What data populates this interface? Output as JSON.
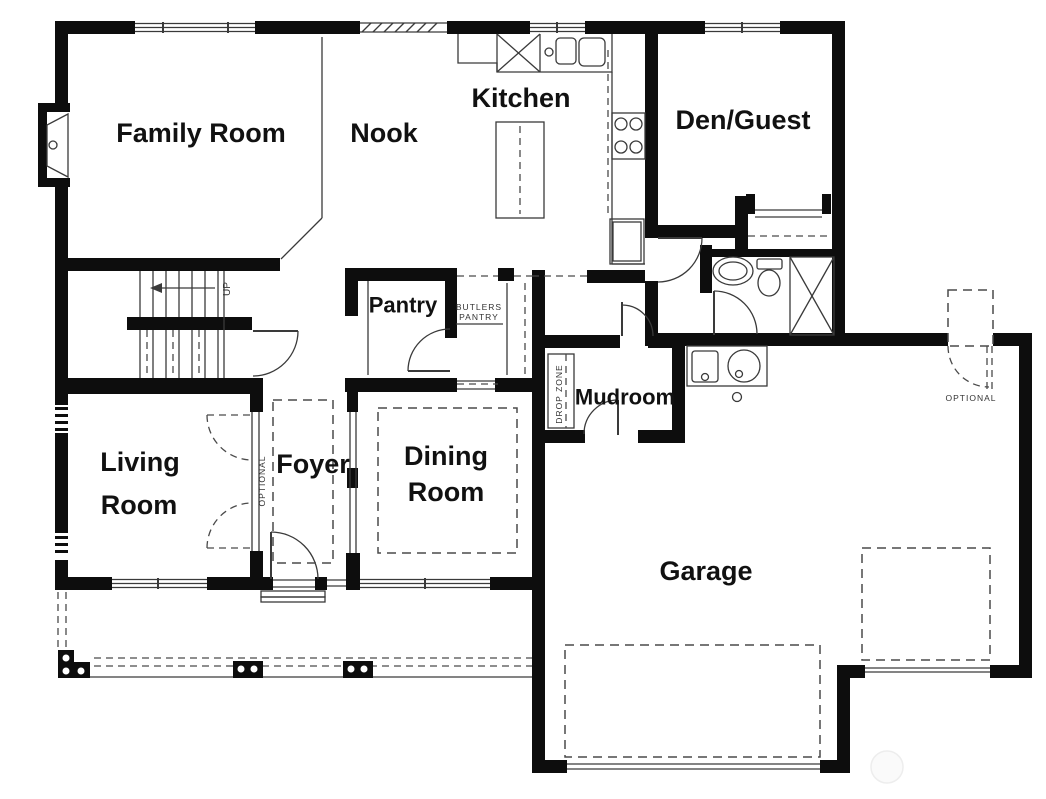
{
  "document": {
    "type": "residential-first-floor-plan",
    "background": "#ffffff",
    "colors": {
      "wall": "#0d0d0d",
      "thin_line": "#3a3a3a",
      "dashed_line": "#4a4a4a",
      "label_text": "#111111",
      "annotation_text": "#333333",
      "watermark": "#ededed"
    }
  },
  "rooms": {
    "family": {
      "label": "Family Room"
    },
    "nook": {
      "label": "Nook"
    },
    "kitchen": {
      "label": "Kitchen"
    },
    "den": {
      "label": "Den/Guest"
    },
    "pantry": {
      "label": "Pantry"
    },
    "living": {
      "line1": "Living",
      "line2": "Room"
    },
    "foyer": {
      "label": "Foyer"
    },
    "dining": {
      "line1": "Dining",
      "line2": "Room"
    },
    "mudroom": {
      "label": "Mudroom"
    },
    "garage": {
      "label": "Garage"
    }
  },
  "annotations": {
    "butlers_pantry_line1": "BUTLERS",
    "butlers_pantry_line2": "PANTRY",
    "drop_zone": "DROP ZONE",
    "foyer_optional": "OPTIONAL",
    "garage_optional": "OPTIONAL",
    "stairs_up": "UP"
  },
  "fixtures": [
    "fireplace",
    "staircase-up",
    "kitchen-corner-cabinet",
    "kitchen-sink",
    "kitchen-island",
    "cooktop",
    "refrigerator",
    "bathroom-vanity",
    "toilet",
    "shower",
    "closet-rod",
    "utility-sink",
    "water-heater",
    "double-garage-door",
    "single-garage-door",
    "optional-exterior-door",
    "optional-french-doors",
    "front-door",
    "porch-posts"
  ]
}
